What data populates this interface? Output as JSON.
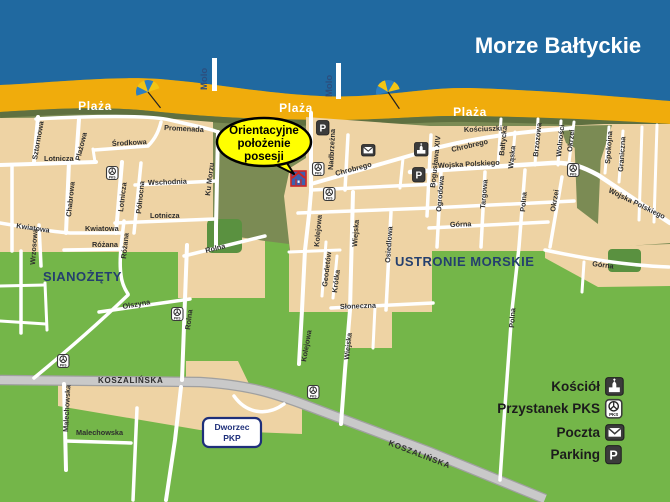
{
  "sea_label": "Morze Bałtyckie",
  "beach": {
    "plaza": "Plaża",
    "molo": "Molo"
  },
  "towns": {
    "sianozety": "SIANOŻĘTY",
    "ustronie_morskie": "USTRONIE MORSKIE"
  },
  "callout": {
    "line1": "Orientacyjne",
    "line2": "położenie",
    "line3": "posesji"
  },
  "station_box": {
    "line1": "Dworzec",
    "line2": "PKP"
  },
  "roads": {
    "koszalinska": "KOSZALIŃSKA"
  },
  "streets": {
    "sztormowa": "Sztormowa",
    "plazowa": "Plażowa",
    "srodkowa": "Środkowa",
    "lotnicza": "Lotnicza",
    "chabrowa": "Chabrowa",
    "polnocna": "Północna",
    "wschodnia": "Wschodnia",
    "kwiatowa": "Kwiatowa",
    "rozana": "Różana",
    "wrzosowa": "Wrzosowa",
    "olszyna": "Olszyna",
    "rolna": "Rolna",
    "malechowska": "Malechowska",
    "promenada": "Promenada",
    "ku_morzu": "Ku Morzu",
    "nadbrzezna": "Nadbrzeżna",
    "kolejowa": "Kolejowa",
    "geodetow": "Geodetów",
    "krotka": "Krótka",
    "wiejska": "Wiejska",
    "osiedlowa": "Osiedlowa",
    "sloneczna": "Słoneczna",
    "chrobrego": "Chrobrego",
    "kosciuszki": "Kościuszki",
    "boguslawa": "Bogusława XIV",
    "wojska_polskiego": "Wojska Polskiego",
    "baltycka": "Bałtycka",
    "waska": "Wąska",
    "brzozowa": "Brzozowa",
    "wolnosci": "Wolności",
    "okrzei": "Okrzei",
    "spokojna": "Spokojna",
    "graniczna": "Graniczna",
    "ogrodowa": "Ogrodowa",
    "targowa": "Targowa",
    "polna": "Polna",
    "gorna": "Górna"
  },
  "legend": {
    "items": [
      {
        "label": "Kościół",
        "icon": "church-icon"
      },
      {
        "label": "Przystanek PKS",
        "icon": "pks-icon"
      },
      {
        "label": "Poczta",
        "icon": "mail-icon"
      },
      {
        "label": "Parking",
        "icon": "parking-icon"
      }
    ]
  },
  "icon_glyphs": {
    "parking": "P",
    "pks": "PKS"
  },
  "colors": {
    "sea": "#2069a0",
    "beach": "#f0ac0c",
    "dune": "#5f7040",
    "land_olive": "#7b8b54",
    "land_green": "#74b649",
    "forest": "#5a9140",
    "block": "#eed3a4",
    "road": "#c9c9c9",
    "street": "#ffffff",
    "callout_fill": "#ffff00",
    "navy": "#243f6e",
    "marker_blue": "#3f5fae",
    "marker_red": "#cc2626"
  }
}
